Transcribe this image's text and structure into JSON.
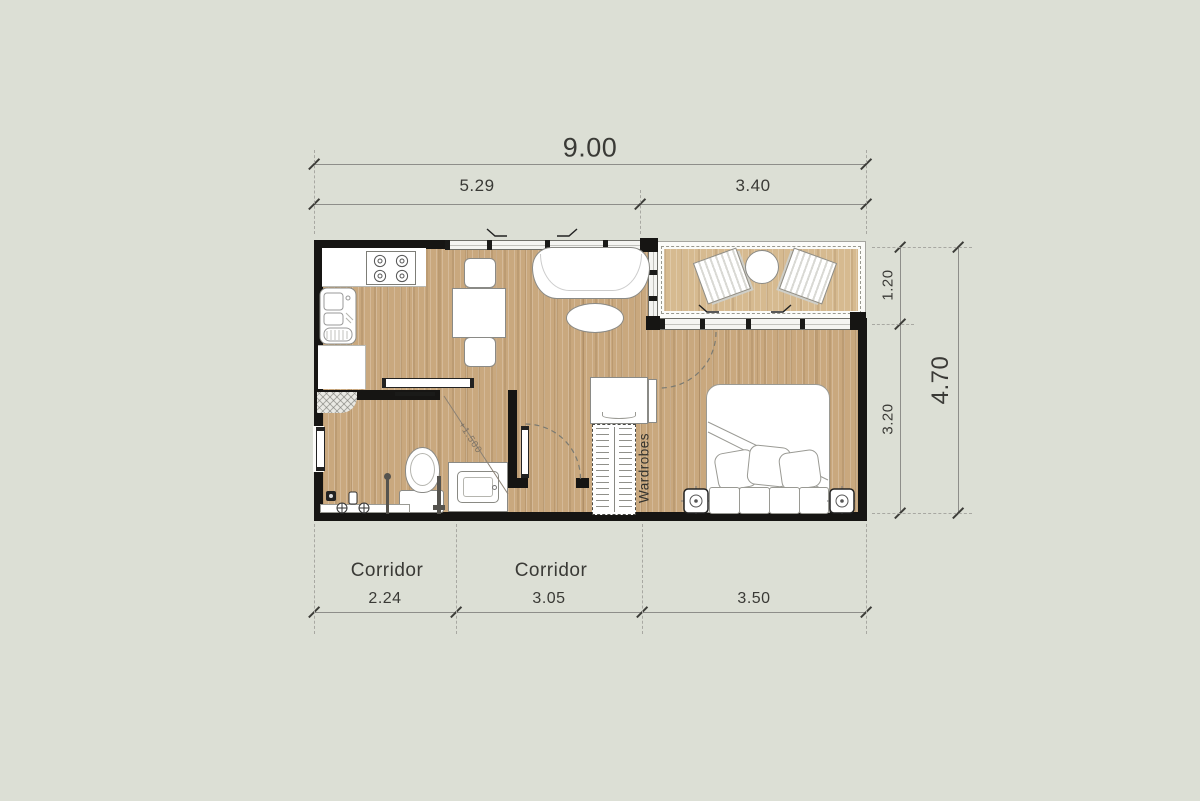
{
  "plan": {
    "type": "floor-plan",
    "units": "meters"
  },
  "dimensions": {
    "top_total": "9.00",
    "top_segments": [
      "5.29",
      "3.40"
    ],
    "right_segments": [
      "1.20",
      "3.20"
    ],
    "right_total": "4.70",
    "bottom_segments": [
      "2.24",
      "3.05",
      "3.50"
    ]
  },
  "rooms": {
    "corridor_labels": [
      "Corridor",
      "Corridor"
    ],
    "wardrobes_label": "Wardrobes"
  },
  "annotations": {
    "slope": "+1.500"
  },
  "symbols": {
    "stove": "four-burner-cooktop",
    "kitchen-sink": "double-basin-sink",
    "dining-set": "table-with-two-chairs",
    "sofa": "curved-sofa",
    "coffee-table": "oval-table",
    "terrace-set": "two-lounge-chairs-round-table",
    "bed": "double-bed-with-pillows",
    "nightstand": "square-table-with-lamp",
    "wardrobes": "dashed-wardrobe-with-hangers",
    "toilet": "toilet-with-tank",
    "vanity": "counter-with-basin",
    "shower": "faucet-drain-and-poles"
  },
  "colors": {
    "background": "#dcdfd5",
    "wall": "#161513",
    "floor_wood": "#c9a87e",
    "terrace_wood": "#d6ba90",
    "dim_line": "#8e8e8a",
    "text": "#3a3a36",
    "furniture_outline": "#8a8a86"
  }
}
